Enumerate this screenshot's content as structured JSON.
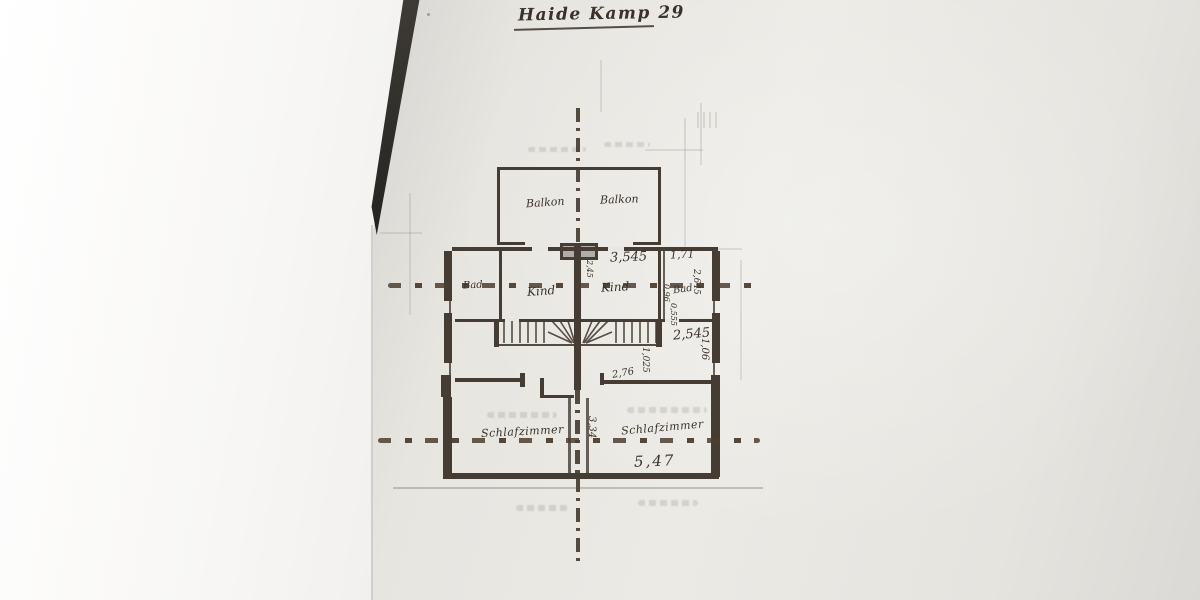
{
  "title": {
    "text": "Haide Kamp 29"
  },
  "plan": {
    "rooms": {
      "balcony_left": "Balkon",
      "balcony_right": "Balkon",
      "bath_left": "Bad",
      "child_left": "Kind",
      "child_right": "Kind",
      "bath_right": "Bad",
      "bedroom_left": "Schlafzimmer",
      "bedroom_right": "Schlafzimmer"
    },
    "dimensions": {
      "child_right_width": "3,545",
      "bath_right_width": "1,71",
      "bath_right_depth": "2,645",
      "bath_fixture_a": "0,96",
      "bath_fixture_b": "0,555",
      "party_wall_detail": "2,45",
      "stair_run": "2,545",
      "stair_landing_depth": "1,06",
      "landing_width": "1,025",
      "hall_width": "2,76",
      "bedroom_depth": "3,34",
      "bedroom_right_width": "5,47"
    }
  },
  "colors": {
    "ink": "#453c33",
    "paper": "#e8e6e1",
    "fold_line": "#4d3e2f",
    "backdrop": "#fbfaf8"
  }
}
